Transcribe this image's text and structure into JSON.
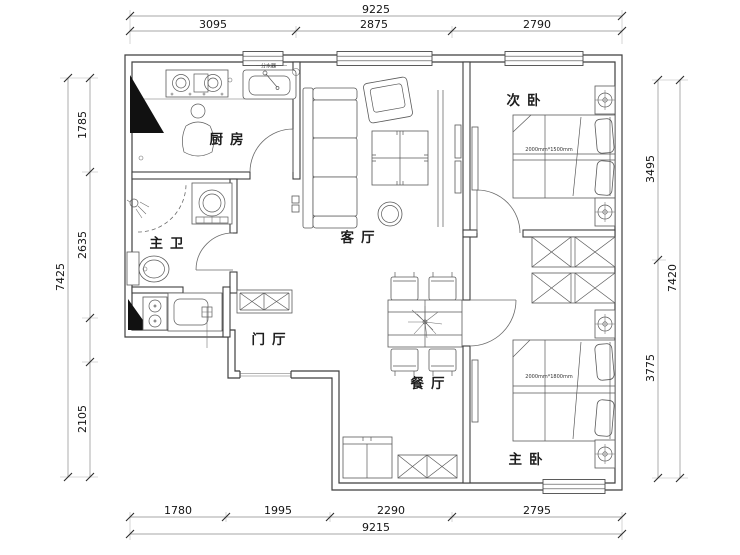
{
  "plan": {
    "rooms": {
      "kitchen": "厨房",
      "master_bath": "主卫",
      "foyer": "门厅",
      "living_room": "客厅",
      "dining_room": "餐厅",
      "second_bedroom": "次卧",
      "master_bedroom": "主卧"
    },
    "annotations": {
      "sink_note": "分水器",
      "second_bed_size": "2000mm*1500mm",
      "master_bed_size": "2000mm*1800mm"
    }
  },
  "dimensions": {
    "top": {
      "overall": "9225",
      "segments": [
        "3095",
        "2875",
        "2790"
      ]
    },
    "bottom": {
      "overall": "9215",
      "segments": [
        "1780",
        "1995",
        "2290",
        "2795"
      ]
    },
    "left": {
      "overall": "7425",
      "segments": [
        "1785",
        "2635",
        "2105"
      ]
    },
    "right": {
      "overall": "7420",
      "segments": [
        "3495",
        "3775"
      ]
    }
  },
  "colors": {
    "wall": "#3f3f3f",
    "furniture": "#5a5a5a",
    "dimension_line": "#8a8a8a",
    "text": "#141414",
    "background": "#ffffff"
  }
}
